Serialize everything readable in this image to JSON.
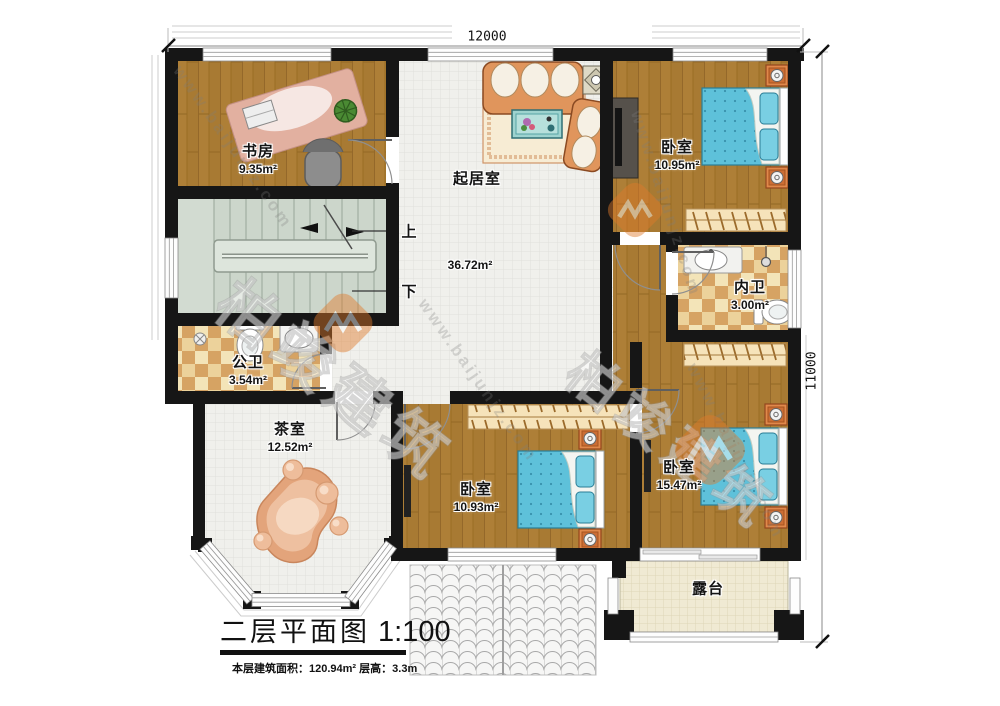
{
  "title": {
    "text": "二层平面图",
    "scale": "1:100"
  },
  "footer": {
    "area_label": "本层建筑面积：",
    "area_value": "120.94m²",
    "height_label": "  层高：",
    "height_value": "3.3m"
  },
  "dimensions": {
    "width": "12000",
    "height": "11000"
  },
  "stairs": {
    "up": "上",
    "down": "下"
  },
  "rooms": {
    "study": {
      "name": "书房",
      "area": "9.35m²"
    },
    "living": {
      "name": "起居室",
      "area": "36.72m²"
    },
    "bedroom_top": {
      "name": "卧室",
      "area": "10.95m²"
    },
    "bath_inner": {
      "name": "内卫",
      "area": "3.00m²"
    },
    "bath_public": {
      "name": "公卫",
      "area": "3.54m²"
    },
    "tea": {
      "name": "茶室",
      "area": "12.52m²"
    },
    "bedroom_mid": {
      "name": "卧室",
      "area": "10.93m²"
    },
    "bedroom_right": {
      "name": "卧室",
      "area": "15.47m²"
    },
    "terrace": {
      "name": "露台"
    }
  },
  "watermark": {
    "brand": "柏竣建筑",
    "url": "www.baijunjz.com"
  }
}
